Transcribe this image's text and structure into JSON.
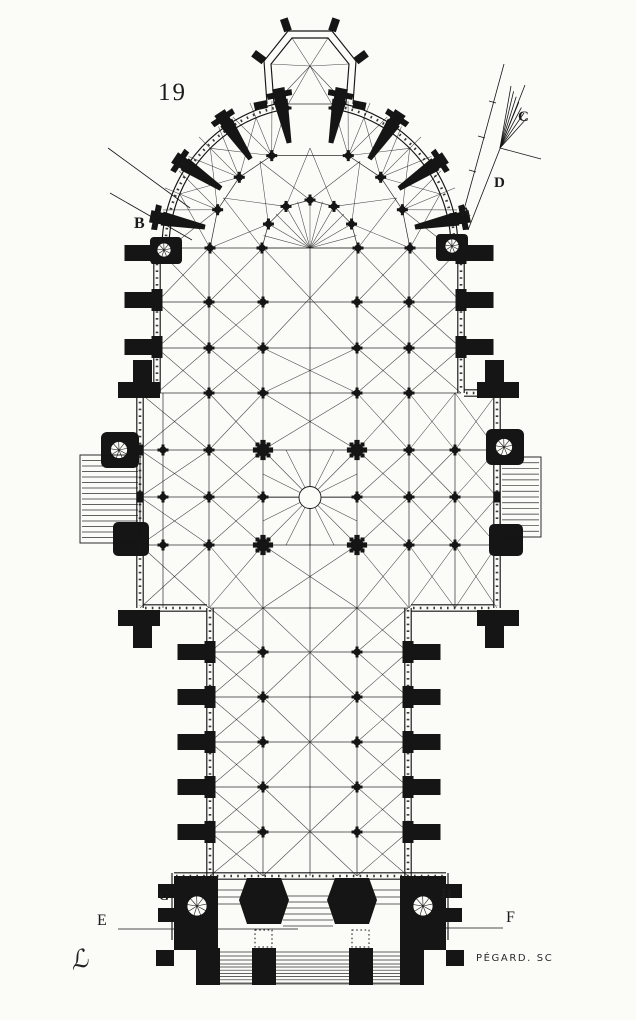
{
  "page": {
    "paper_color": "#fbfbf8",
    "ink_color": "#151515"
  },
  "figure_number": "19",
  "reference_letters": {
    "a": "A",
    "b": "B",
    "c": "C",
    "d": "D",
    "e": "E",
    "f": "F",
    "g": "G",
    "h": "H"
  },
  "engraver_credit": "PÉGARD. SC",
  "artist_monogram": "ℒ"
}
